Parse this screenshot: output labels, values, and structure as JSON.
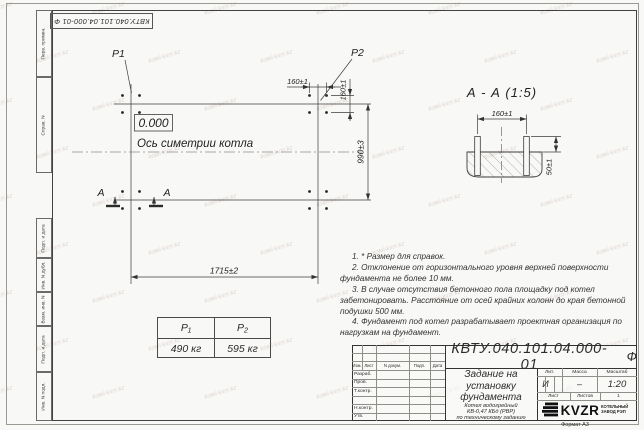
{
  "sheet": {
    "stamp_top": "КВТУ.040.101.04.000-01  Ф",
    "format_label": "Формат А3",
    "margin_top": [
      "Перв. примен.",
      "Справ. N"
    ],
    "margin_bottom": [
      "Подп. и дата",
      "Инв. N дубл.",
      "Взам. инв. N",
      "Подп. и дата",
      "Инв. N подл."
    ]
  },
  "watermark": {
    "text": "kotel-kvzr.kz"
  },
  "plan": {
    "p1_label": "P1",
    "p2_label": "P2",
    "level_mark": "0.000",
    "symmetry_axis_label": "Ось симетрии котла",
    "dim_length": "1715±2",
    "dim_width": "990±3",
    "dim_bolt_spacing_x": "160±1",
    "dim_bolt_spacing_y": "160±1",
    "section_mark": "А"
  },
  "section": {
    "title": "А - А (1:5)",
    "dim_bolt_spacing": "160±1",
    "dim_bolt_height": "50±1"
  },
  "load_table": {
    "col1_header": "P₁",
    "col2_header": "P₂",
    "col1_value": "490 кг",
    "col2_value": "595 кг"
  },
  "notes": [
    "1. * Размер для справок.",
    "2. Отклонение от горизонтального уровня верхней поверхности фундамента не более 10 мм.",
    "3. В случае отсутствия бетонного пола площадку под котел забетонировать. Расстояние от осей крайних колонн до края бетонной подушки 500 мм.",
    "4. Фундамент под котел разрабатывает проектная организация по нагрузкам на фундамент."
  ],
  "title_block": {
    "doc_number": "КВТУ.040.101.04.000-01",
    "doc_suffix": "Ф",
    "title_lines": [
      "Задание на",
      "установку",
      "фундамента"
    ],
    "product_lines": [
      "Котел водогрейный",
      "КВ-0,47 КБд (РВР)",
      "по техническому заданию"
    ],
    "rev_headers": [
      "Изм.",
      "Лист",
      "N докум.",
      "Подп.",
      "Дата"
    ],
    "sign_labels": [
      "Разраб.",
      "Пров.",
      "Т.контр.",
      "",
      "Н.контр.",
      "Утв."
    ],
    "lit_header": "Лит.",
    "mass_header": "Масса",
    "scale_header": "Масштаб",
    "lit_value": "И",
    "mass_value": "–",
    "scale_value": "1:20",
    "sheet_label": "Лист",
    "sheets_label": "Листов",
    "sheets_value": "1",
    "logo_text": "KVZR",
    "logo_caption": [
      "КОТЕЛЬНЫЙ",
      "ЗАВОД РЭП"
    ]
  }
}
